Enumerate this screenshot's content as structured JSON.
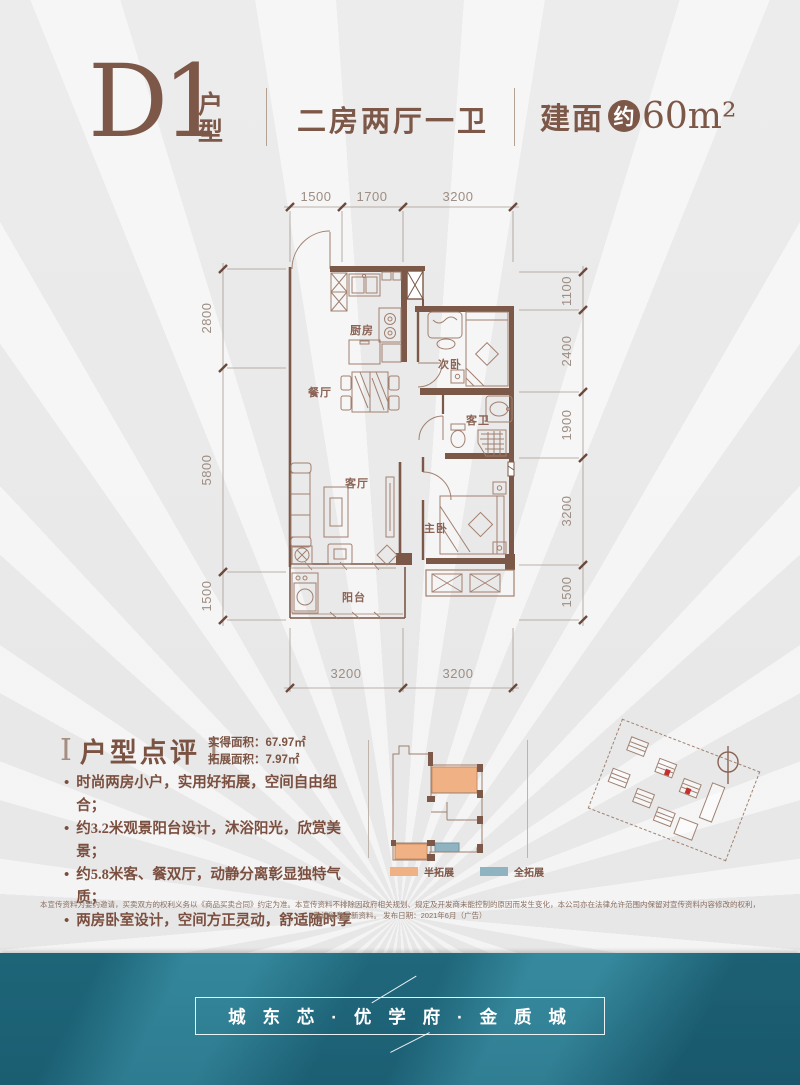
{
  "header": {
    "plan_code": "D1",
    "plan_code_suffix": "户型",
    "layout_label": "二房两厅一卫",
    "area_prefix": "建面",
    "area_circle_char": "约",
    "area_value": "60m²"
  },
  "floor_plan": {
    "dims_top": [
      "1500",
      "1700",
      "3200"
    ],
    "dims_left": [
      "2800",
      "5800",
      "1500"
    ],
    "dims_right": [
      "1100",
      "2400",
      "1900",
      "3200",
      "1500"
    ],
    "dims_bottom": [
      "3200",
      "3200"
    ],
    "rooms": {
      "kitchen": "厨房",
      "dining": "餐厅",
      "second_bedroom": "次卧",
      "guest_bath": "客卫",
      "living": "客厅",
      "master_bedroom": "主卧",
      "balcony": "阳台"
    }
  },
  "review": {
    "title": "户型点评",
    "bracket": "Ⅰ",
    "area_line1": "实得面积：67.97㎡",
    "area_line2": "拓展面积：7.97㎡",
    "bullet_char": "•",
    "bullets": [
      "时尚两房小户，实用好拓展，空间自由组合；",
      "约3.2米观景阳台设计，沐浴阳光，欣赏美景；",
      "约5.8米客、餐双厅，动静分离彰显独特气质；",
      "两房卧室设计，空间方正灵动，舒适随时享"
    ]
  },
  "expansion_legend": {
    "half_label": "半拓展",
    "half_color": "#f0b284",
    "full_label": "全拓展",
    "full_color": "#8fb3c0"
  },
  "disclaimer": "本宣传资料为要约邀请，买卖双方的权利义务以《商品买卖合同》约定为准。本宣传资料不排除因政府相关规划、规定及开发商未能控制的原因而发生变化，本公司亦在法律允许范围内保留对宣传资料内容修改的权利，敬请留意最新资料。 发布日期：2021年6月（广告）",
  "banner": {
    "slogan": "城 东 芯 · 优 学 府 · 金 质 城",
    "bg_color": "#2e7f93"
  },
  "colors": {
    "accent_brown": "#7d5848",
    "wall_brown": "#7b5848",
    "furniture_brown": "#a2806f",
    "dim_gray": "#9d8d83",
    "highlight_red": "#c4302b"
  }
}
